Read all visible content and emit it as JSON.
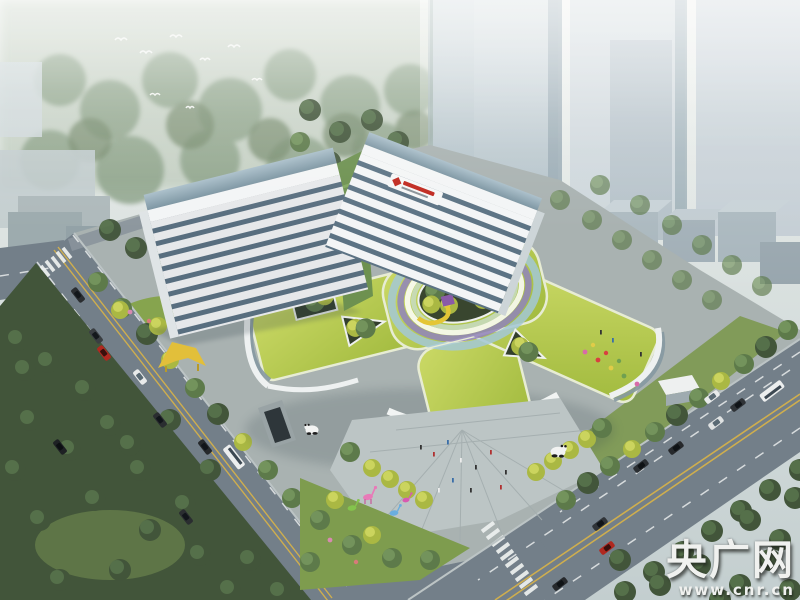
{
  "scene": {
    "description": "Aerial architectural rendering of a hospital campus: two V-shaped white tower slabs above a podium with a yellow-green roof garden, circular rainbow courtyard with play blocks, entrance plaza with sculptures, tree-lined roads and a hazy city skyline"
  },
  "watermark": {
    "brand": "央广网",
    "url": "www.cnr.cn"
  },
  "palette": {
    "sky_top": "#eaeeea",
    "sky_bottom": "#c9d3d4",
    "road": "#737f89",
    "road_light": "#8a949c",
    "sidewalk": "#a9b2b1",
    "lane_yellow": "#cfae4e",
    "park_dark": "#42553a",
    "lawn": "#7e9c4e",
    "tower_white": "#f3f5f6",
    "tower_glass": "#5c7384",
    "roof_green": "#aec449",
    "ring_blue": "#a4c8d6",
    "ring_purple": "#9184bc",
    "ring_green": "#c8dcc4",
    "block_red": "#e03224",
    "block_yellow": "#e4c636",
    "block_purple": "#8a5aa8",
    "sign_red": "#c0281e",
    "wm": "#f0f1ef"
  }
}
